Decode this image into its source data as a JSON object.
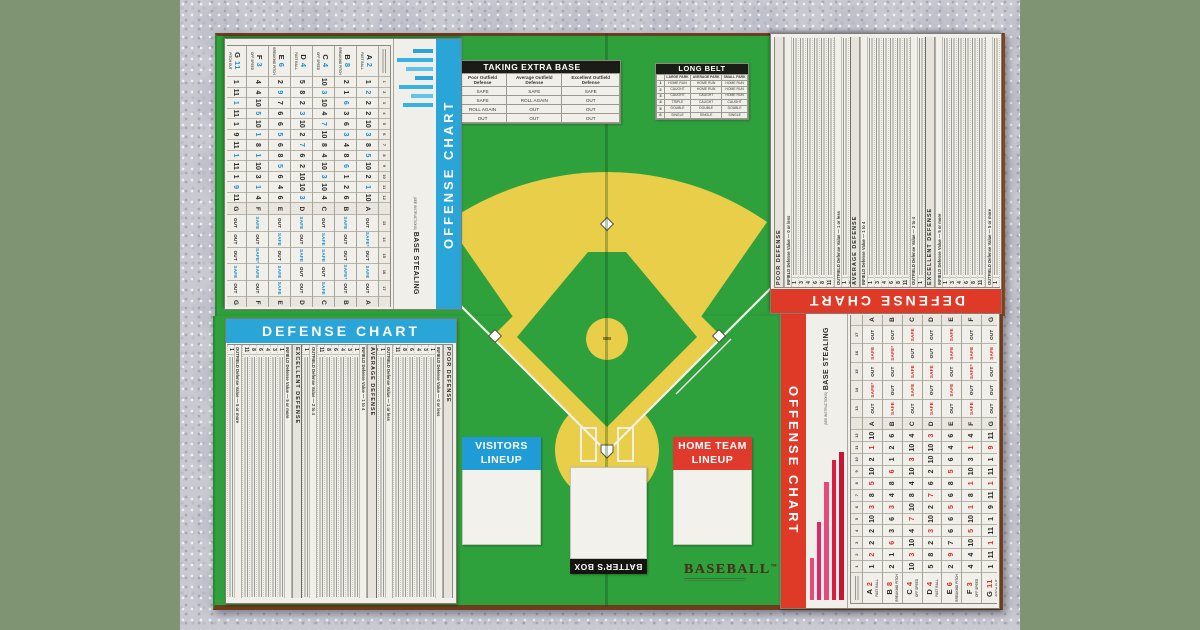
{
  "colors": {
    "backdrop": "#7e9472",
    "carpet": "#c9c9d2",
    "board_green": "#2fa13c",
    "board_edge_brown": "#84461f",
    "field_yellow": "#e8ce49",
    "offense_red": "#df3a28",
    "offense_blue": "#2aa5d8",
    "banner_black": "#1b1b17",
    "chart_paper": "#f0efe9",
    "accent_red": "#d62f24",
    "accent_blue": "#1f8fd0",
    "bar_pink": "#e8487c",
    "bar_magenta": "#e4256b",
    "bar_red": "#c81535"
  },
  "logo": {
    "word": "BASEBALL",
    "tm": "TM"
  },
  "batters_box": {
    "label": "BATTER'S BOX"
  },
  "visitors_lineup": {
    "line1": "VISITORS",
    "line2": "LINEUP"
  },
  "home_lineup": {
    "line1": "HOME TEAM",
    "line2": "LINEUP"
  },
  "taking_extra_base": {
    "title": "TAKING EXTRA BASE",
    "columns": [
      "Poor Outfield Defense",
      "Average Outfield Defense",
      "Excellent Outfield Defense"
    ],
    "rows": [
      {
        "label": "1-2",
        "values": [
          "SAFE",
          "SAFE",
          "SAFE"
        ]
      },
      {
        "label": "3",
        "values": [
          "SAFE",
          "ROLL AGAIN",
          "OUT"
        ]
      },
      {
        "label": "4",
        "values": [
          "ROLL AGAIN",
          "OUT",
          "OUT"
        ]
      },
      {
        "label": "5-6",
        "values": [
          "OUT",
          "OUT",
          "OUT"
        ]
      }
    ]
  },
  "long_belt": {
    "title": "LONG BELT",
    "columns": [
      "LARGE PARK",
      "AVERAGE PARK",
      "SMALL PARK"
    ],
    "rows": [
      {
        "label": "1",
        "values": [
          "HOME RUN",
          "HOME RUN",
          "HOME RUN"
        ]
      },
      {
        "label": "2",
        "values": [
          "CAUGHT",
          "HOME RUN",
          "HOME RUN"
        ]
      },
      {
        "label": "3",
        "values": [
          "CAUGHT",
          "CAUGHT",
          "HOME RUN"
        ]
      },
      {
        "label": "4",
        "values": [
          "TRIPLE",
          "CAUGHT",
          "CAUGHT"
        ]
      },
      {
        "label": "5",
        "values": [
          "DOUBLE",
          "DOUBLE",
          "DOUBLE"
        ]
      },
      {
        "label": "6",
        "values": [
          "SINGLE",
          "SINGLE",
          "SINGLE"
        ]
      }
    ]
  },
  "offense_chart": {
    "title": "OFFENSE CHART",
    "base_stealing": "BASE STEALING",
    "base_stealing_sub": "(SEE INSTRUCTIONS)",
    "letters": [
      "A",
      "B",
      "C",
      "D",
      "E",
      "F",
      "G"
    ],
    "column_numbers": [
      "1",
      "2",
      "3",
      "4",
      "5",
      "6",
      "7",
      "8",
      "9",
      "10",
      "11",
      "12",
      "13",
      "14",
      "15",
      "16",
      "17"
    ],
    "rows": [
      {
        "label": "A 2",
        "pitch": "FAST BALL",
        "numbers": [
          "1",
          "!2",
          "2",
          "2",
          "10",
          "!3",
          "8",
          "!5",
          "10",
          "2",
          "!1",
          "10"
        ],
        "steal": [
          "OUT",
          "SAFE*",
          "OUT",
          "SAFE",
          "OUT"
        ]
      },
      {
        "label": "B 8",
        "pitch": "BREAKING PITCH",
        "numbers": [
          "2",
          "1",
          "!6",
          "3",
          "6",
          "!3",
          "4",
          "8",
          "!6",
          "1",
          "2",
          "6"
        ],
        "steal": [
          "SAFE",
          "OUT",
          "OUT",
          "SAFE*",
          "OUT"
        ]
      },
      {
        "label": "C 4",
        "pitch": "OFF SPEED",
        "numbers": [
          "10",
          "!3",
          "10",
          "4",
          "!7",
          "10",
          "8",
          "4",
          "10",
          "!3",
          "10",
          "4"
        ],
        "steal": [
          "OUT",
          "SAFE",
          "SAFE",
          "OUT",
          "SAFE"
        ]
      },
      {
        "label": "D 4",
        "pitch": "FAST BALL",
        "numbers": [
          "5",
          "8",
          "2",
          "!3",
          "10",
          "2",
          "!7",
          "6",
          "2",
          "10",
          "10",
          "!3"
        ],
        "steal": [
          "SAFE",
          "OUT",
          "SAFE",
          "OUT",
          "OUT"
        ]
      },
      {
        "label": "E 6",
        "pitch": "BREAKING PITCH",
        "numbers": [
          "2",
          "!9",
          "7",
          "6",
          "6",
          "!5",
          "6",
          "8",
          "!5",
          "6",
          "4",
          "6"
        ],
        "steal": [
          "OUT",
          "SAFE",
          "OUT",
          "SAFE",
          "SAFE"
        ]
      },
      {
        "label": "F 3",
        "pitch": "OFF SPEED",
        "numbers": [
          "4",
          "4",
          "10",
          "!5",
          "10",
          "!1",
          "8",
          "!1",
          "10",
          "3",
          "!1",
          "4"
        ],
        "steal": [
          "SAFE",
          "OUT",
          "SAFE*",
          "SAFE",
          "OUT"
        ]
      },
      {
        "label": "G 11",
        "pitch": "PITCH OUT",
        "numbers": [
          "1",
          "11",
          "!1",
          "11",
          "1",
          "9",
          "11",
          "!1",
          "11",
          "1",
          "!9",
          "11"
        ],
        "steal": [
          "OUT",
          "OUT",
          "OUT",
          "SAFE",
          "OUT"
        ]
      }
    ]
  },
  "defense_chart": {
    "title": "DEFENSE CHART",
    "sections": [
      {
        "title": "POOR DEFENSE",
        "subsections": [
          {
            "title": "INFIELD Defense Value — 0 or less",
            "rows": [
              "1",
              "3",
              "4",
              "6",
              "8",
              "11"
            ]
          },
          {
            "title": "OUTFIELD Defense Value — 1 or less",
            "rows": [
              "1",
              "3",
              "5",
              "7",
              "10"
            ]
          },
          {
            "title": "CATCHER Defense Value — 1",
            "rows": [
              "2",
              "8"
            ]
          }
        ]
      },
      {
        "title": "AVERAGE DEFENSE",
        "subsections": [
          {
            "title": "INFIELD Defense Value — 1 to 4",
            "rows": [
              "1",
              "3",
              "4",
              "6",
              "8",
              "11"
            ]
          },
          {
            "title": "OUTFIELD Defense Value — 2 to 4",
            "rows": [
              "1",
              "3",
              "5",
              "7",
              "10"
            ]
          },
          {
            "title": "CATCHER Defense Value — 2",
            "rows": [
              "2",
              "8"
            ]
          }
        ]
      },
      {
        "title": "EXCELLENT DEFENSE",
        "subsections": [
          {
            "title": "INFIELD Defense Value — 5 or more",
            "rows": [
              "1",
              "3",
              "4",
              "6",
              "8",
              "11"
            ]
          },
          {
            "title": "OUTFIELD Defense Value — 5 or more",
            "rows": [
              "1",
              "3",
              "5",
              "7",
              "10"
            ]
          },
          {
            "title": "CATCHER Defense Value — 3",
            "rows": [
              "2",
              "8"
            ]
          }
        ]
      }
    ]
  }
}
